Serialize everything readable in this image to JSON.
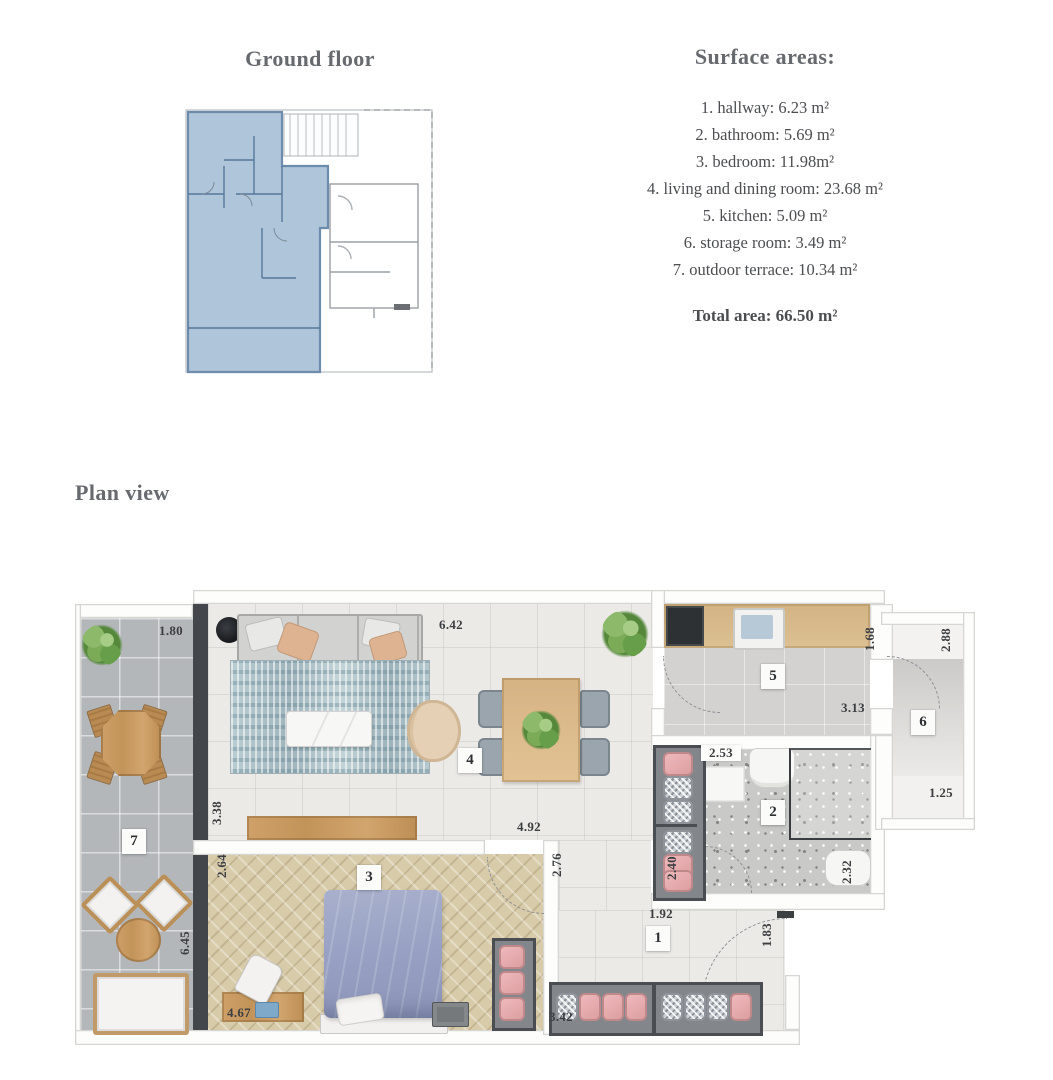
{
  "ground_floor": {
    "title": "Ground floor",
    "highlight_color": "#a9c1d7"
  },
  "surface_areas": {
    "title": "Surface areas:",
    "items": [
      "1. hallway: 6.23 m²",
      "2. bathroom: 5.69 m²",
      "3. bedroom: 11.98m²",
      "4. living and dining room: 23.68 m²",
      "5. kitchen: 5.09 m²",
      "6. storage room: 3.49 m²",
      "7. outdoor terrace: 10.34 m²"
    ],
    "total": "Total area: 66.50 m²"
  },
  "plan_view": {
    "title": "Plan view",
    "room_labels": [
      {
        "number": "1",
        "name": "hallway"
      },
      {
        "number": "2",
        "name": "bathroom"
      },
      {
        "number": "3",
        "name": "bedroom"
      },
      {
        "number": "4",
        "name": "living-and-dining-room"
      },
      {
        "number": "5",
        "name": "kitchen"
      },
      {
        "number": "6",
        "name": "storage-room"
      },
      {
        "number": "7",
        "name": "outdoor-terrace"
      }
    ],
    "dimensions": [
      {
        "text": "1.80"
      },
      {
        "text": "6.42"
      },
      {
        "text": "1.68"
      },
      {
        "text": "2.88"
      },
      {
        "text": "3.13"
      },
      {
        "text": "1.25"
      },
      {
        "text": "2.53"
      },
      {
        "text": "2.32"
      },
      {
        "text": "3.38"
      },
      {
        "text": "4.92"
      },
      {
        "text": "2.76"
      },
      {
        "text": "2.64"
      },
      {
        "text": "2.40"
      },
      {
        "text": "1.92"
      },
      {
        "text": "1.83"
      },
      {
        "text": "6.45"
      },
      {
        "text": "4.67"
      },
      {
        "text": "3.42"
      }
    ]
  },
  "colors": {
    "heading": "#66696d",
    "body_text": "#4b4d50",
    "unit_highlight": "#a9c1d7",
    "dark_wall": "#43474b",
    "pink_accent": "#dd9ea1",
    "wood": "#c2945a",
    "bed_blue": "#99a2c4"
  }
}
